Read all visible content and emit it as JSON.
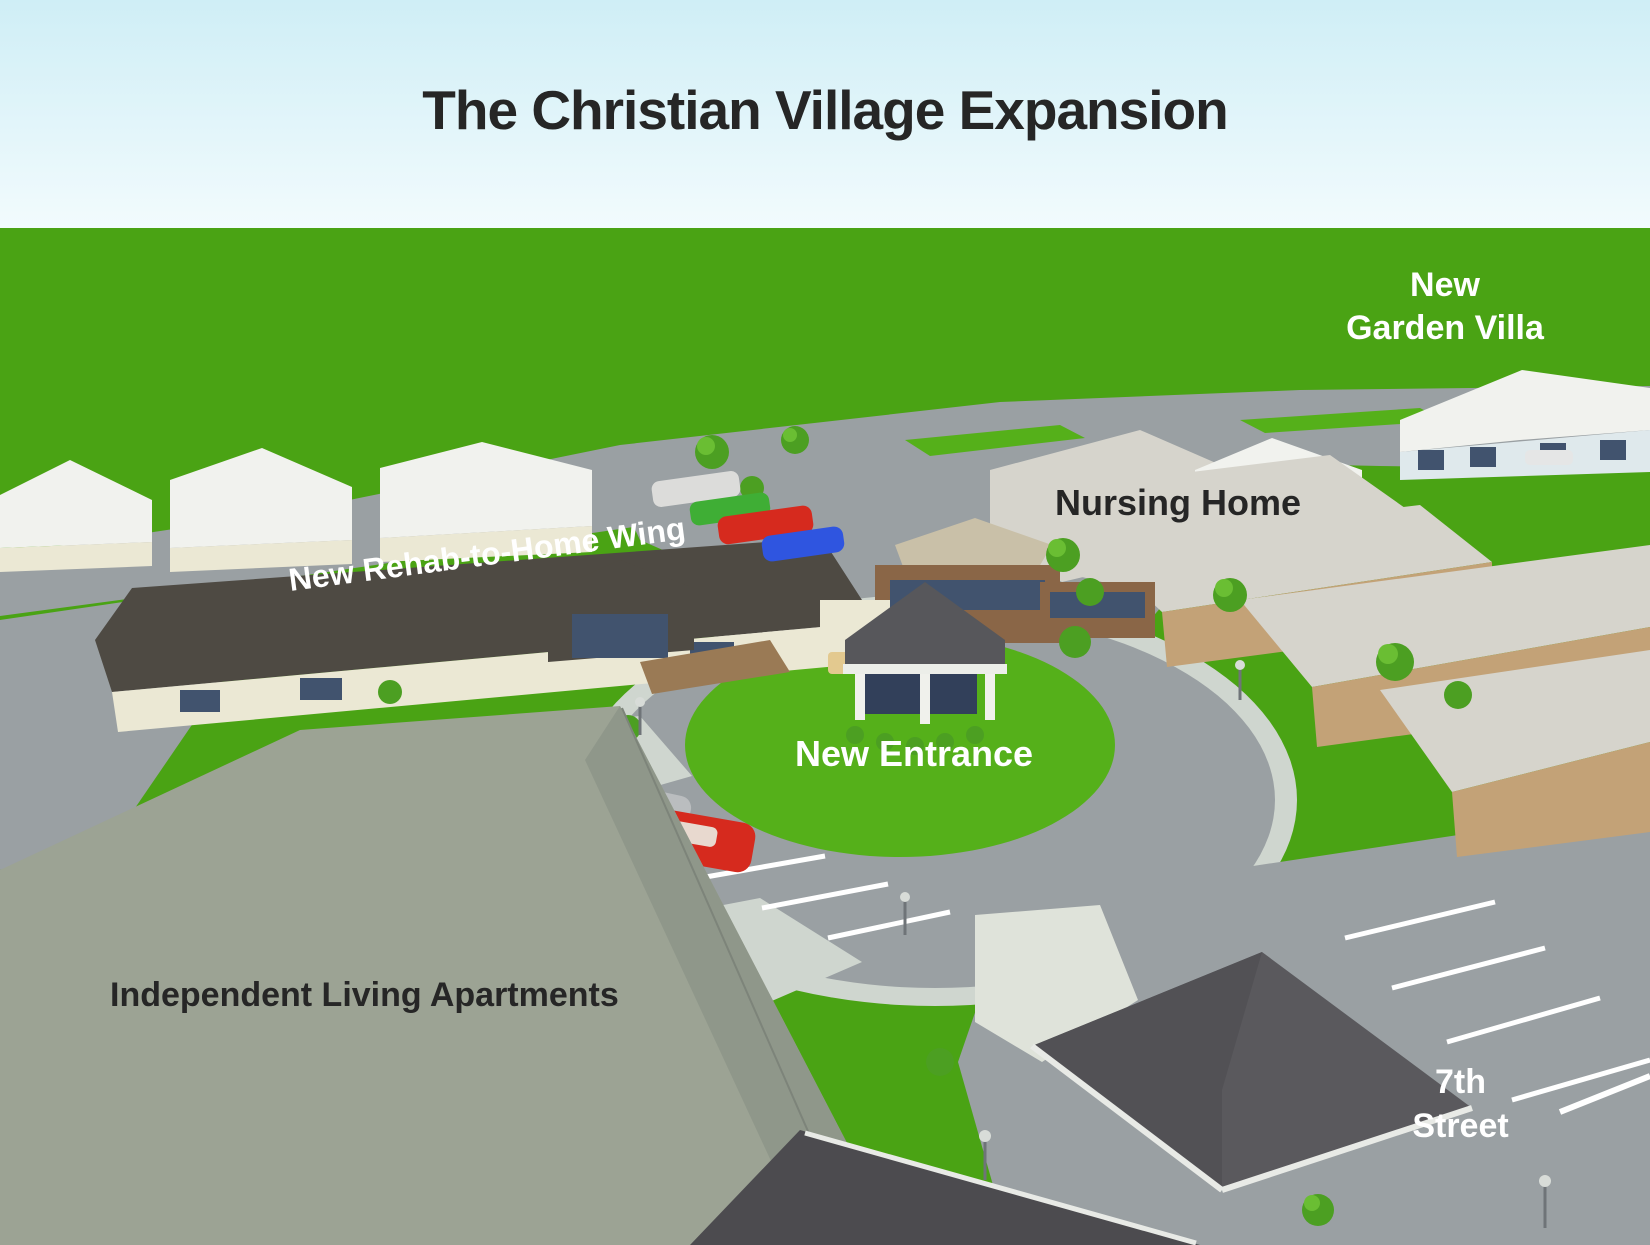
{
  "title": "The Christian Village Expansion",
  "labels": {
    "garden_villa_line1": "New",
    "garden_villa_line2": "Garden Villa",
    "nursing_home": "Nursing Home",
    "rehab_wing": "New Rehab-to-Home Wing",
    "new_entrance": "New Entrance",
    "independent_living": "Independent Living Apartments",
    "street_line1": "7th",
    "street_line2": "Street"
  },
  "colors": {
    "sky_top": "#cfeef6",
    "sky_bottom": "#f2fbfd",
    "grass": "#4aa314",
    "lawn": "#55b01a",
    "road": "#9aa0a3",
    "sidewalk": "#cfd6cf",
    "concrete": "#dfe3da",
    "dark_roof": "#4e4a43",
    "canopy_roof": "#5a595d",
    "canopy_shade": "#4c4b4f",
    "white_roof": "#f1f2ee",
    "cottage_wall": "#ebe8d4",
    "tan_roof": "#d6d4cc",
    "tan_wall": "#c3a277",
    "brick": "#8a6647",
    "glass": "#41536e",
    "tower_roof": "#c9c0a8",
    "ila_roof": "#9ca394",
    "ila_roof_dark": "#8f978a",
    "label_dark": "#262626",
    "label_light": "#ffffff",
    "car_silver": "#babdbf",
    "car_red": "#d62a1e",
    "car_green": "#3fae35",
    "car_blue": "#2f55e0",
    "car_white": "#dcdcda",
    "tree_green": "#4c9f22",
    "tree_light": "#6abe33",
    "lamp_gray": "#6f7478"
  }
}
